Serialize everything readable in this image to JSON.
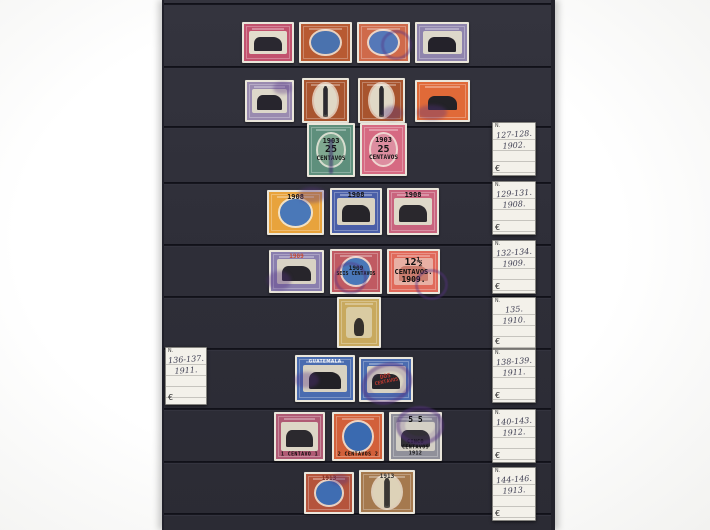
{
  "page": {
    "description": "photograph of a dark stockbook album page holding used Guatemala stamps 1902-1913",
    "background_color": "#f7f7f5",
    "board_color": "#2e2e38",
    "seam_color": "#15151d",
    "board_left": 162,
    "board_right": 549,
    "seams_y": [
      3,
      66,
      126,
      182,
      244,
      296,
      348,
      408,
      461,
      513
    ],
    "cancel_color": "#563282"
  },
  "labels": [
    {
      "name": "label-1902",
      "x": 492,
      "y": 122,
      "w": 42,
      "h": 52,
      "header": "N.",
      "line1": "127-128.",
      "line2": "1902.",
      "currency": "€"
    },
    {
      "name": "label-1908",
      "x": 492,
      "y": 181,
      "w": 42,
      "h": 52,
      "header": "N.",
      "line1": "129-131.",
      "line2": "1908.",
      "currency": "€"
    },
    {
      "name": "label-1909",
      "x": 492,
      "y": 240,
      "w": 42,
      "h": 52,
      "header": "N.",
      "line1": "132-134.",
      "line2": "1909.",
      "currency": "€"
    },
    {
      "name": "label-1910",
      "x": 492,
      "y": 297,
      "w": 42,
      "h": 50,
      "header": "N.",
      "line1": "135.",
      "line2": "1910.",
      "currency": "€"
    },
    {
      "name": "label-1911-left",
      "x": 165,
      "y": 347,
      "w": 40,
      "h": 56,
      "header": "N.",
      "line1": "136-137.",
      "line2": "1911.",
      "currency": "€"
    },
    {
      "name": "label-1911",
      "x": 492,
      "y": 349,
      "w": 42,
      "h": 52,
      "header": "N.",
      "line1": "138-139.",
      "line2": "1911.",
      "currency": "€"
    },
    {
      "name": "label-1912",
      "x": 492,
      "y": 409,
      "w": 42,
      "h": 52,
      "header": "N.",
      "line1": "140-143.",
      "line2": "1912.",
      "currency": "€"
    },
    {
      "name": "label-1913",
      "x": 492,
      "y": 467,
      "w": 42,
      "h": 52,
      "header": "N.",
      "line1": "144-146.",
      "line2": "1913.",
      "currency": "€"
    }
  ],
  "stamps": [
    {
      "name": "stamp-r1c1",
      "x": 240,
      "y": 22,
      "w": 52,
      "h": 41,
      "frame": "#c2526e",
      "shape": "scene",
      "vig2": "#e2dccc",
      "vignette": "#2a2830"
    },
    {
      "name": "stamp-r1c2",
      "x": 297,
      "y": 22,
      "w": 53,
      "h": 41,
      "frame": "#b85a32",
      "shape": "ovalblue",
      "vignette": "#4a72ae"
    },
    {
      "name": "stamp-r1c3",
      "x": 355,
      "y": 22,
      "w": 53,
      "h": 41,
      "frame": "#cf6a4a",
      "shape": "ovalblue",
      "vignette": "#5578b8",
      "cancel": {
        "type": "ring",
        "l": "45%",
        "t": "20%",
        "w": "48%",
        "h": "58%",
        "rot": -10
      }
    },
    {
      "name": "stamp-r1c4",
      "x": 413,
      "y": 22,
      "w": 54,
      "h": 41,
      "frame": "#8f84ad",
      "shape": "scene",
      "vig2": "#ddd8ca",
      "vignette": "#24222a"
    },
    {
      "name": "stamp-r2c1",
      "x": 243,
      "y": 80,
      "w": 49,
      "h": 42,
      "frame": "#9a8bb0",
      "shape": "scene",
      "vig2": "#ddd8ca",
      "vignette": "#27252d",
      "cancel": {
        "type": "smear",
        "l": "58%",
        "t": "4%",
        "w": "38%",
        "h": "30%"
      }
    },
    {
      "name": "stamp-r2c2",
      "x": 300,
      "y": 78,
      "w": 47,
      "h": 45,
      "frame": "#a8542e",
      "shape": "column",
      "vig2": "#e0d8c6",
      "vignette": "#2c2a30"
    },
    {
      "name": "stamp-r2c3",
      "x": 356,
      "y": 78,
      "w": 47,
      "h": 45,
      "frame": "#a8542e",
      "shape": "column",
      "vig2": "#e0d8c6",
      "vignette": "#2c2a30",
      "cancel": {
        "type": "smear",
        "l": "50%",
        "t": "62%",
        "w": "45%",
        "h": "32%"
      }
    },
    {
      "name": "stamp-r2c4",
      "x": 413,
      "y": 80,
      "w": 55,
      "h": 42,
      "frame": "#e06a38",
      "shape": "scene",
      "vig2": "#e06a38",
      "vignette": "#232227",
      "cancel": {
        "type": "smear",
        "l": "4%",
        "t": "60%",
        "w": "55%",
        "h": "35%"
      }
    },
    {
      "name": "stamp-r3c1-1903-25c",
      "x": 305,
      "y": 123,
      "w": 48,
      "h": 54,
      "frame": "#5e8f7c",
      "shape": "ovalblue",
      "vignette": "#7fa890",
      "overprint": {
        "pos": "mid",
        "color": "#141414",
        "lines": [
          {
            "t": "1903",
            "s": 7
          },
          {
            "t": "25",
            "s": 10
          },
          {
            "t": "CENTAVOS",
            "s": 6
          }
        ]
      },
      "cancel": {
        "type": "vline",
        "l": "46%",
        "t": "30%",
        "w": "9%",
        "h": "65%"
      }
    },
    {
      "name": "stamp-r3c2-1903-25c",
      "x": 358,
      "y": 123,
      "w": 47,
      "h": 53,
      "frame": "#d66a82",
      "shape": "ovalblue",
      "vignette": "#dd8ea0",
      "overprint": {
        "pos": "mid",
        "color": "#141414",
        "lines": [
          {
            "t": "1903",
            "s": 7
          },
          {
            "t": "25",
            "s": 10
          },
          {
            "t": "CENTAVOS",
            "s": 6
          }
        ]
      }
    },
    {
      "name": "stamp-r4c1-1908",
      "x": 265,
      "y": 190,
      "w": 57,
      "h": 45,
      "frame": "#e8a33c",
      "shape": "ovalblue",
      "vignette": "#4a78b8",
      "overprint": {
        "pos": "top",
        "color": "#161616",
        "lines": [
          {
            "t": "1908",
            "s": 7
          }
        ]
      },
      "cancel": {
        "type": "smear",
        "l": "55%",
        "t": "-6%",
        "w": "48%",
        "h": "34%"
      }
    },
    {
      "name": "stamp-r4c2-1908",
      "x": 328,
      "y": 188,
      "w": 52,
      "h": 47,
      "frame": "#4a5fa8",
      "shape": "scene",
      "vig2": "#d8d2c2",
      "vignette": "#262429",
      "overprint": {
        "pos": "top",
        "color": "#111111",
        "lines": [
          {
            "t": "1908",
            "s": 7
          }
        ]
      }
    },
    {
      "name": "stamp-r4c3-1908",
      "x": 385,
      "y": 188,
      "w": 52,
      "h": 47,
      "frame": "#c9647e",
      "shape": "scene",
      "vig2": "#ded8c8",
      "vignette": "#2a282d",
      "overprint": {
        "pos": "top",
        "color": "#111111",
        "lines": [
          {
            "t": "1908",
            "s": 7
          }
        ]
      }
    },
    {
      "name": "stamp-r5c1-1909",
      "x": 267,
      "y": 250,
      "w": 55,
      "h": 43,
      "frame": "#8a7fae",
      "shape": "scene",
      "vig2": "#d8d2c4",
      "vignette": "#27252b",
      "overprint": {
        "pos": "top",
        "color": "#c64a33",
        "lines": [
          {
            "t": "1909",
            "s": 6
          }
        ]
      },
      "cancel": {
        "type": "smear",
        "l": "-4%",
        "t": "48%",
        "w": "44%",
        "h": "44%"
      }
    },
    {
      "name": "stamp-r5c2-1909",
      "x": 328,
      "y": 249,
      "w": 52,
      "h": 45,
      "frame": "#c05a62",
      "shape": "ovalblue",
      "vignette": "#4a78b8",
      "overprint": {
        "pos": "mid",
        "color": "#141414",
        "lines": [
          {
            "t": "1909",
            "s": 6
          },
          {
            "t": "SEIS CENTAVOS",
            "s": 5
          }
        ]
      },
      "cancel": {
        "type": "ring",
        "l": "8%",
        "t": "28%",
        "w": "52%",
        "h": "58%",
        "rot": 14
      }
    },
    {
      "name": "stamp-r5c3-1909-12half",
      "x": 385,
      "y": 249,
      "w": 53,
      "h": 45,
      "frame": "#e0695a",
      "shape": "scene",
      "vig2": "#e8b0a4",
      "vignette": "#c97c6e",
      "overprint": {
        "pos": "mid",
        "color": "#0e0e0e",
        "lines": [
          {
            "t": "12½",
            "s": 10
          },
          {
            "t": "CENTAVOS.",
            "s": 7
          },
          {
            "t": "1909.",
            "s": 8
          }
        ]
      },
      "cancel": {
        "type": "ring",
        "l": "52%",
        "t": "44%",
        "w": "52%",
        "h": "55%",
        "rot": 0
      }
    },
    {
      "name": "stamp-r6c1-1910",
      "x": 335,
      "y": 297,
      "w": 44,
      "h": 51,
      "frame": "#c8a95e",
      "shape": "portrait",
      "vig2": "#d9cba2",
      "vignette": "#34302c"
    },
    {
      "name": "stamp-r7c1-1911",
      "x": 293,
      "y": 355,
      "w": 60,
      "h": 47,
      "frame": "#4a6cb0",
      "shape": "scene",
      "vig2": "#d8d2c2",
      "vignette": "#222126",
      "tband": "GUATEMALA",
      "cancel": {
        "type": "smear",
        "l": "-2%",
        "t": "36%",
        "w": "42%",
        "h": "34%"
      }
    },
    {
      "name": "stamp-r7c2-1911",
      "x": 357,
      "y": 357,
      "w": 54,
      "h": 45,
      "frame": "#4a6cb0",
      "shape": "scene",
      "vig2": "#d8d2c2",
      "vignette": "#26252a",
      "overprint": {
        "pos": "mid",
        "color": "#c03a30",
        "rot": -12,
        "lines": [
          {
            "t": "DOS",
            "s": 6
          },
          {
            "t": "CENTAVOS",
            "s": 5
          }
        ]
      },
      "cancel": {
        "type": "heavy",
        "l": "4%",
        "t": "14%",
        "w": "82%",
        "h": "74%",
        "rot": -20
      }
    },
    {
      "name": "stamp-r8c1-1912",
      "x": 272,
      "y": 412,
      "w": 51,
      "h": 49,
      "frame": "#b05a74",
      "shape": "scene",
      "vig2": "#ddd6c6",
      "vignette": "#2b292e",
      "banner": "1 CENTAVO 1"
    },
    {
      "name": "stamp-r8c2-1912",
      "x": 330,
      "y": 412,
      "w": 52,
      "h": 49,
      "frame": "#d2603a",
      "shape": "ovalblue",
      "vignette": "#3a6ab0",
      "banner": "2 CENTAVOS 2"
    },
    {
      "name": "stamp-r8c3-1912",
      "x": 387,
      "y": 412,
      "w": 53,
      "h": 49,
      "frame": "#90909a",
      "shape": "scene",
      "vig2": "#d4d0c6",
      "vignette": "#323036",
      "overprint": {
        "pos": "top",
        "color": "#0e0e0e",
        "lines": [
          {
            "t": "5      5",
            "s": 8
          }
        ]
      },
      "banner": "CINCO CENTAVOS 1912",
      "cancel": {
        "type": "heavy",
        "l": "14%",
        "t": "-12%",
        "w": "74%",
        "h": "62%",
        "rot": 0
      }
    },
    {
      "name": "stamp-r9c1-1913",
      "x": 302,
      "y": 472,
      "w": 50,
      "h": 42,
      "frame": "#b5543c",
      "shape": "ovalblue",
      "vignette": "#3f6db2",
      "overprint": {
        "pos": "top",
        "color": "#7a2a22",
        "lines": [
          {
            "t": "1913",
            "s": 6
          }
        ]
      },
      "cancel": {
        "type": "smear",
        "l": "52%",
        "t": "4%",
        "w": "38%",
        "h": "28%"
      }
    },
    {
      "name": "stamp-r9c2-1913",
      "x": 357,
      "y": 470,
      "w": 56,
      "h": 44,
      "frame": "#a5794e",
      "shape": "column",
      "vig2": "#ddd2b8",
      "vignette": "#3a3734",
      "overprint": {
        "pos": "top",
        "color": "#2e2c2a",
        "lines": [
          {
            "t": "1913",
            "s": 6
          }
        ]
      }
    }
  ]
}
